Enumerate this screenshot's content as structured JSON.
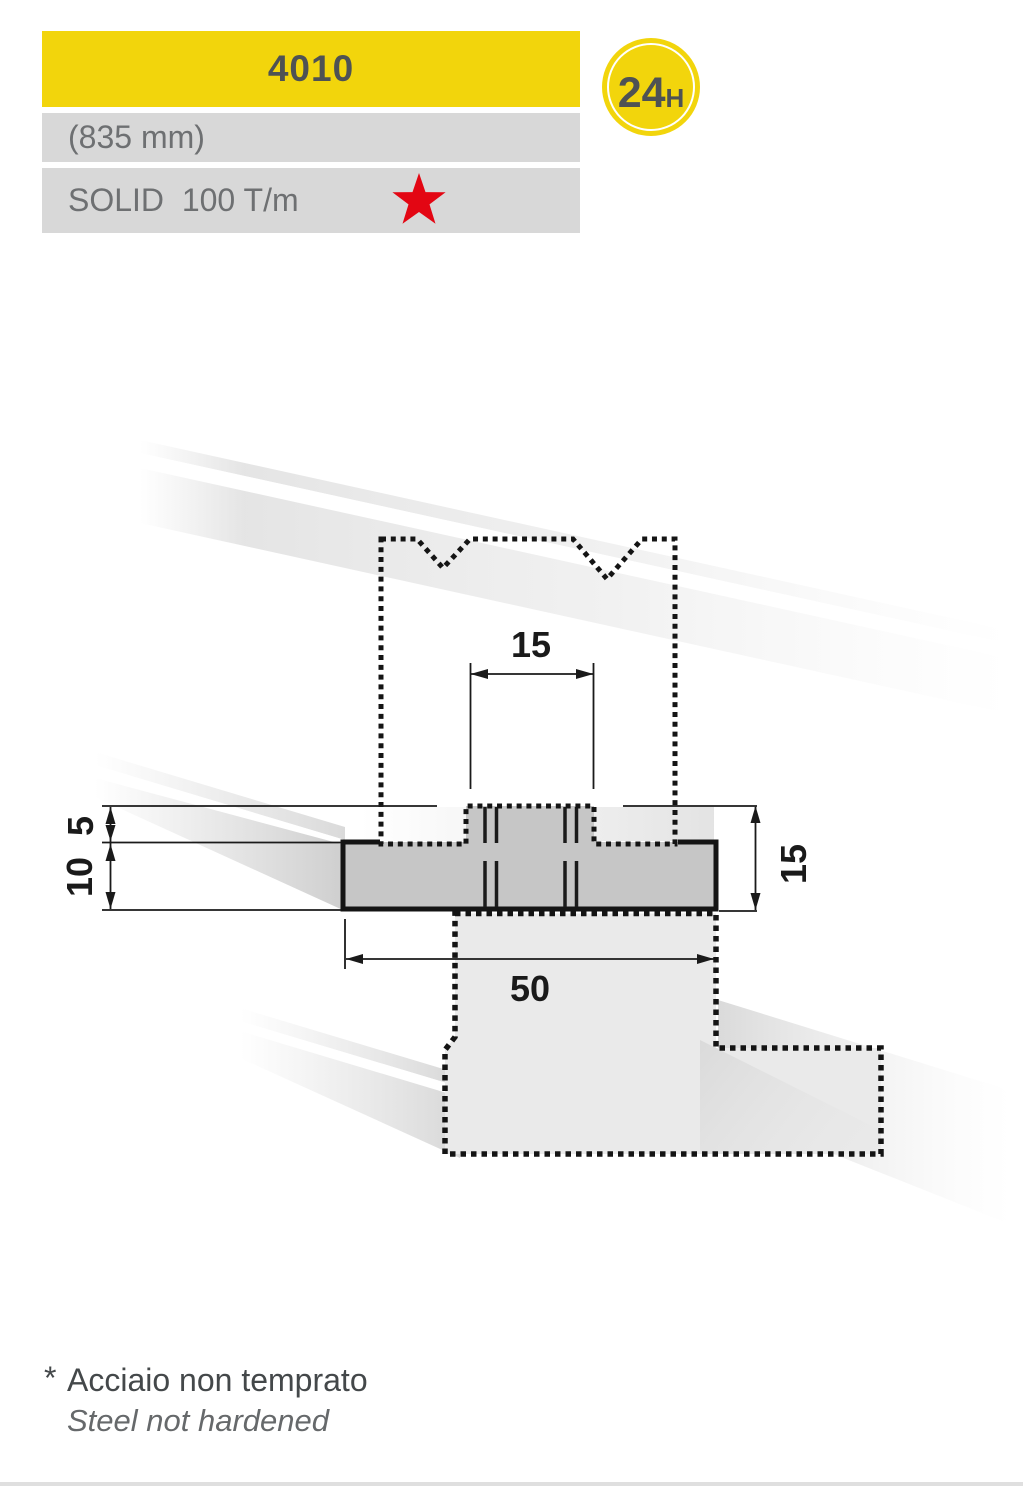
{
  "header": {
    "model": "4010",
    "length": "(835 mm)",
    "spec": "SOLID  100 T/m",
    "badge": {
      "value": "24",
      "unit": "H"
    }
  },
  "drawing": {
    "dims": {
      "slot_width": "15",
      "tang_height": "5",
      "body_height": "10",
      "total_height": "15",
      "body_width": "50"
    }
  },
  "footnote": {
    "marker": "*",
    "line1": "Acciaio non temprato",
    "line2": "Steel not hardened"
  },
  "colors": {
    "accent_yellow": "#F2D50C",
    "bar_gray": "#D8D8D8",
    "star_red": "#E30613",
    "body_gray": "#C6C6C6",
    "support_gray": "#EAEAEA",
    "line_dark": "#141414",
    "title_text": "#4E5254",
    "bar_text": "#6E7072"
  }
}
